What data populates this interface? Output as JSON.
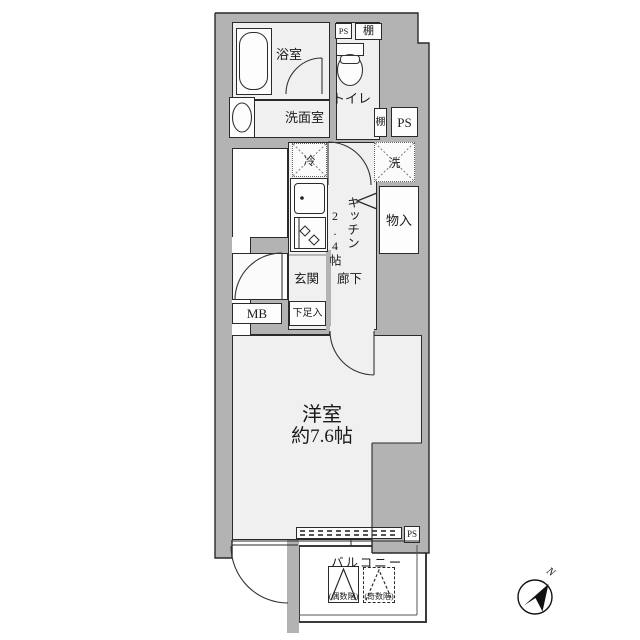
{
  "plan": {
    "title": "apartment-floor-plan",
    "rooms": {
      "bathroom": "浴室",
      "toilet": "トイレ",
      "washroom": "洗面室",
      "kitchen": "キッチン",
      "kitchen_size": "2.4帖",
      "closet": "物入",
      "entrance": "玄関",
      "hallway": "廊下",
      "shoe_box": "下足入",
      "meter_box": "MB",
      "western_room": "洋室",
      "western_room_size": "約7.6帖",
      "balcony": "バルコニー"
    },
    "labels": {
      "ps": "PS",
      "shelf": "棚",
      "fridge": "冷",
      "washer": "洗",
      "even_floor": "(偶数階)",
      "odd_floor": "(奇数階)",
      "north": "N"
    },
    "colors": {
      "wall": "#b3b3b3",
      "floor": "#f0f0f0",
      "line": "#2a2a2a",
      "background": "#ffffff"
    }
  }
}
